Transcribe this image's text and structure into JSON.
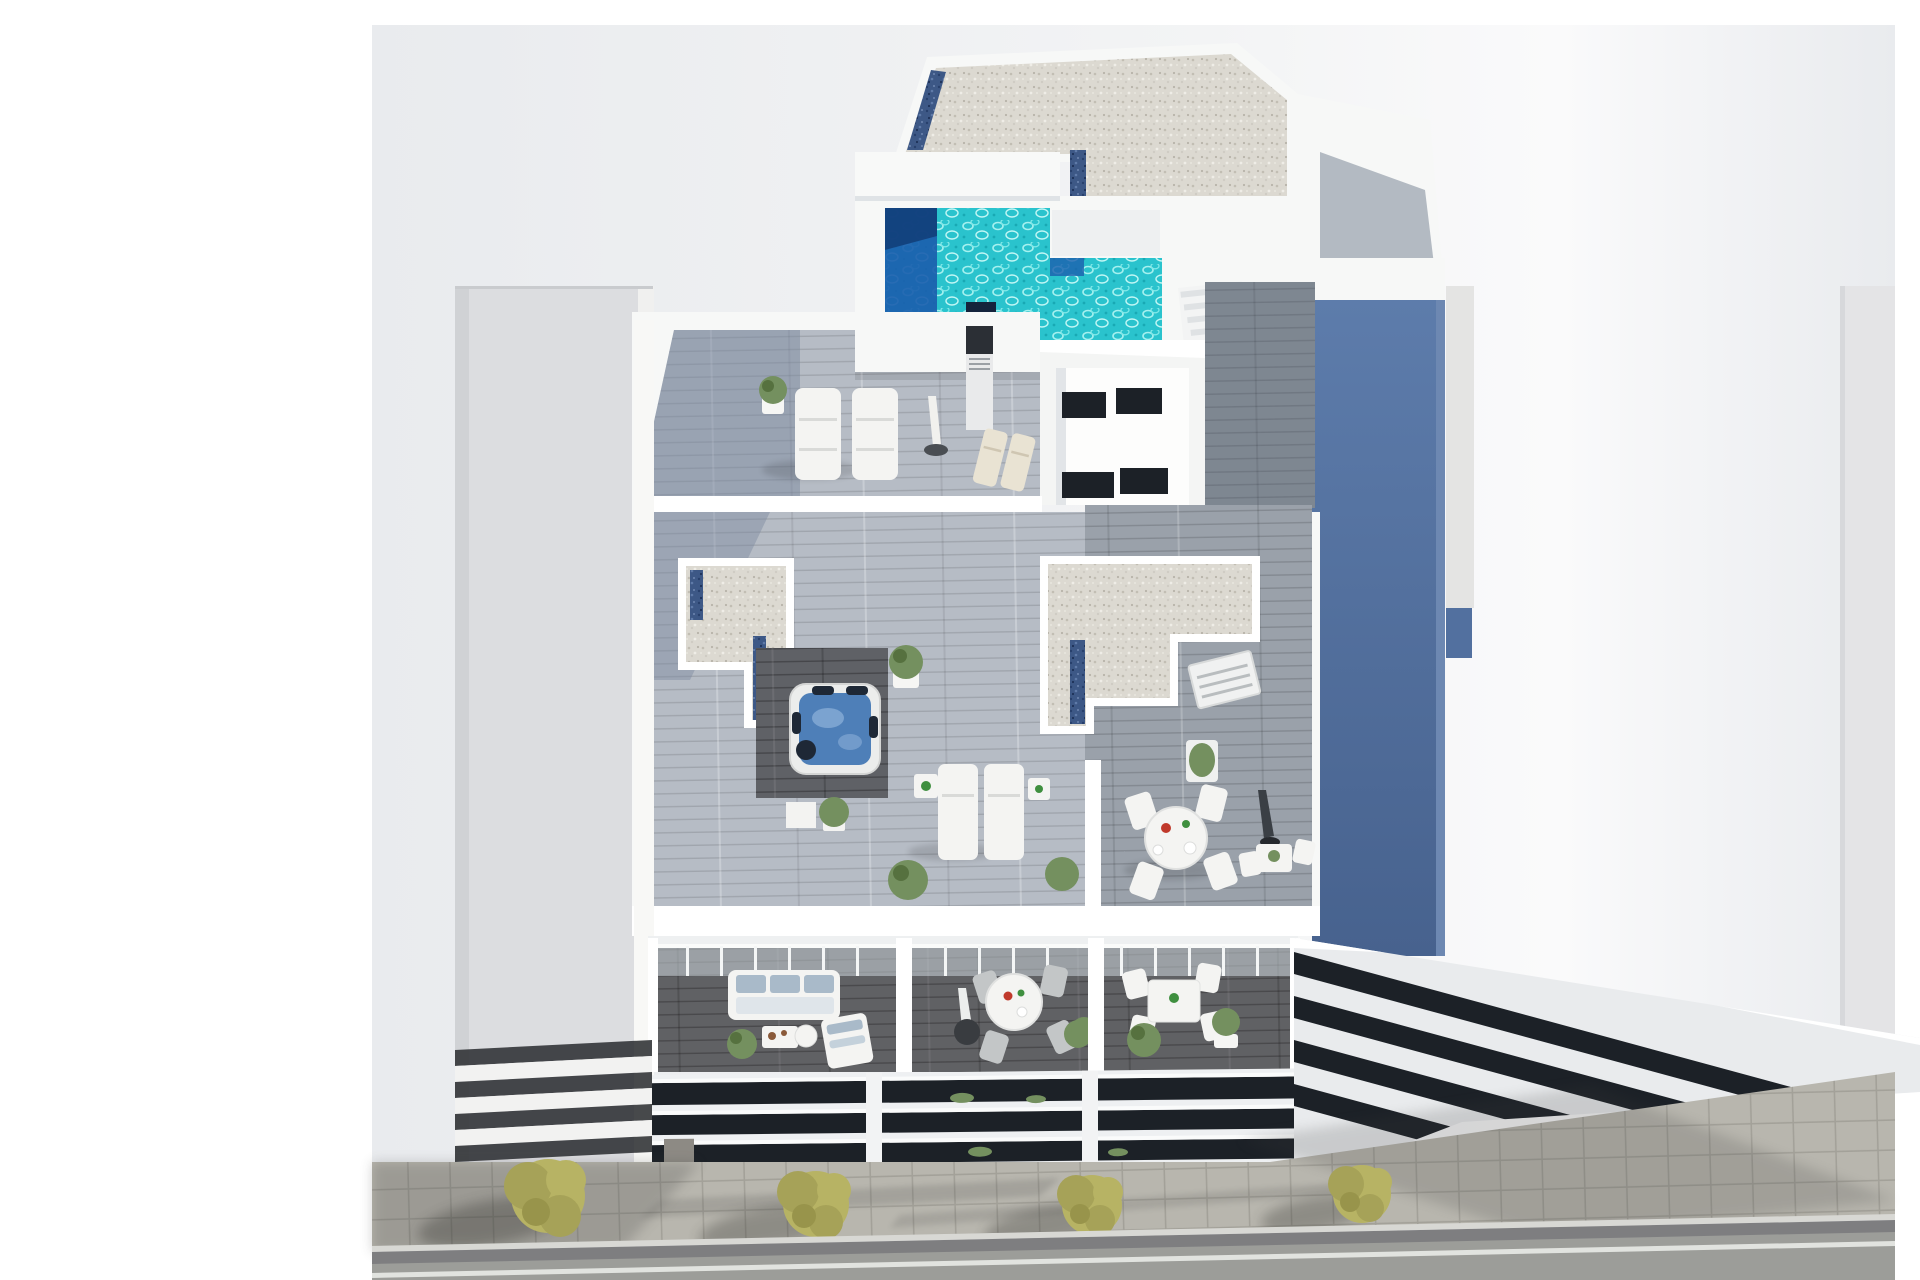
{
  "scene": {
    "title": "Aerial 3D architectural render of a new-build apartment building",
    "description": "Top-down axonometric visualization: white residential building with rooftop swimming pool, gravel roofs with skylight strips, wood-deck sun terraces with loungers and hot tub, three furnished balconies, neighbouring grey buildings, and a street with paved sidewalk and olive trees."
  },
  "inventory": {
    "swimming_pool": 1,
    "hot_tub": 1,
    "sun_loungers": 6,
    "parasols": 3,
    "dining_sets": 3,
    "balconies": 3,
    "street_trees": 4
  },
  "colors": {
    "page_bg": "#ffffff",
    "photo_bg_left": "#e9ebee",
    "photo_bg_mid": "#f3f4f5",
    "photo_bg_right": "#fafafb",
    "white_wall": "#f7f8f7",
    "white_bright": "#ffffff",
    "wall_shade": "#e6e9ec",
    "neighbor_left": "#dcdde0",
    "neighbor_left_dark": "#d0d2d5",
    "neighbor_edge": "#f0f0ef",
    "neighbor_right_top": "#5d7cab",
    "neighbor_right_bottom": "#47628e",
    "neighbor_right_lit": "#e4e4e3",
    "far_right_building": "#e4e4e6",
    "louver_dark": "#1c2127",
    "gravel_base": "#dcd9d1",
    "skylight_base": "#3d5886",
    "pool_water": "#2ac3cd",
    "pool_deep": "#1b5fae",
    "pool_deep_dark": "#123f7a",
    "pool_step": "#14233c",
    "deck_light": "#b6bcc5",
    "deck_mid": "#9aa1aa",
    "deck_dark": "#5f6166",
    "deck_shadow_tint": "#7c89a0",
    "jacuzzi_water": "#4e7fb8",
    "jacuzzi_light": "#8fb2da",
    "jacuzzi_dark": "#1e2836",
    "furniture_white": "#f4f4f2",
    "cushion_blue": "#a9bac9",
    "cream": "#e9e3d3",
    "plant_green": "#74905f",
    "plant_green_dark": "#56713f",
    "tree_olive": "#b7b364",
    "tree_olive_mid": "#a6a258",
    "tree_olive_dark": "#98944b",
    "umbrella_dark": "#3a3f45",
    "metal_dark": "#2b2f35",
    "chair_gray": "#c3c6c7",
    "sidewalk": "#b8b6ae",
    "curb_top": "#d8d8d4",
    "curb_face": "#7e7e80",
    "road": "#9c9d99",
    "lane_line": "#e9ebe7",
    "glass": "#ccd6da",
    "accent_red": "#c0392b",
    "accent_green": "#3f8f3f",
    "table_brown": "#8a5a3a",
    "panel_taupe": "#8d8a84",
    "roof_wedge": "#a7afb8"
  }
}
